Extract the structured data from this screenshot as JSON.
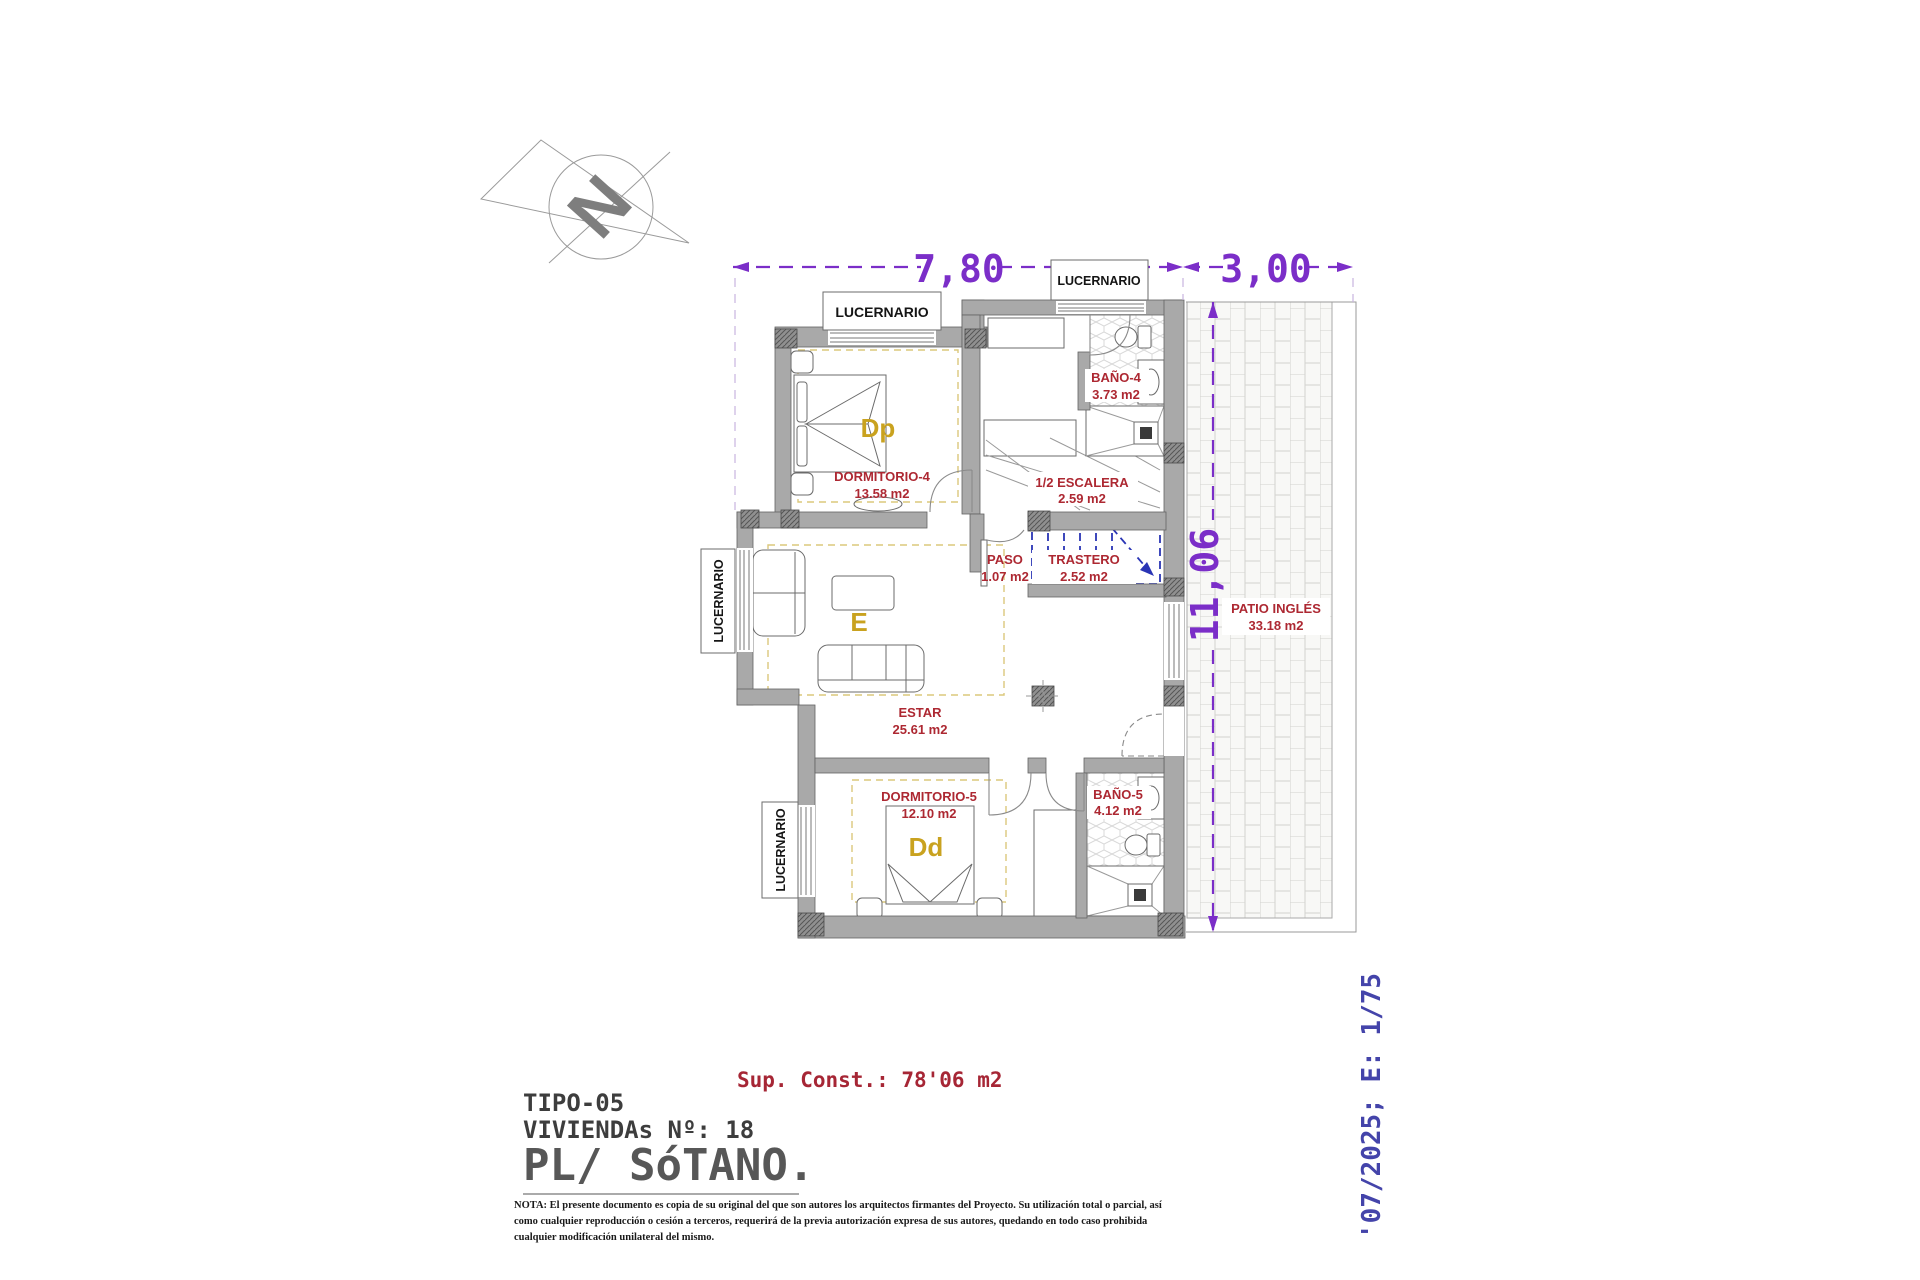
{
  "plan": {
    "north_label": "N",
    "dimensions": {
      "top": "7,80",
      "top_right": "3,00",
      "right": "11,06"
    },
    "skylight": "LUCERNARIO",
    "rooms": {
      "bano4": {
        "name": "BAÑO-4",
        "area": "3.73 m2"
      },
      "dormitorio4": {
        "name": "DORMITORIO-4",
        "area": "13.58 m2",
        "letter": "Dp"
      },
      "escalera": {
        "name": "1/2 ESCALERA",
        "area": "2.59 m2"
      },
      "paso": {
        "name": "PASO",
        "area": "1.07 m2"
      },
      "trastero": {
        "name": "TRASTERO",
        "area": "2.52 m2"
      },
      "estar": {
        "name": "ESTAR",
        "area": "25.61 m2",
        "letter": "E"
      },
      "dormitorio5": {
        "name": "DORMITORIO-5",
        "area": "12.10 m2",
        "letter": "Dd"
      },
      "bano5": {
        "name": "BAÑO-5",
        "area": "4.12 m2"
      },
      "patio": {
        "name": "PATIO INGLÉS",
        "area": "33.18 m2"
      }
    }
  },
  "title_block": {
    "sup_const": "Sup. Const.: 78'06 m2",
    "tipo": "TIPO-05",
    "viviendas": "VIVIENDAs Nº: 18",
    "plano": "PL/ SóTANO.",
    "date_scale": "'07/2025; E: 1/75",
    "note_lines": [
      "NOTA: El presente documento es copia de su original del que son autores los arquitectos firmantes del Proyecto. Su utilización total o parcial, así",
      "como cualquier reproducción o cesión a terceros, requerirá  de la previa autorización expresa de sus autores, quedando en todo caso prohibida",
      "cualquier modificación unilateral del mismo."
    ]
  },
  "colors": {
    "dimension_purple": "#7b2ec8",
    "room_label_red": "#ad2832",
    "room_letter_gold": "#c9a21f",
    "date_scale_blue": "#4444aa",
    "sup_const_red": "#a62635",
    "wall_gray": "#a9a9a9",
    "trastero_blue": "#2a35b5",
    "room_dash_yellow": "#dcc87c"
  }
}
